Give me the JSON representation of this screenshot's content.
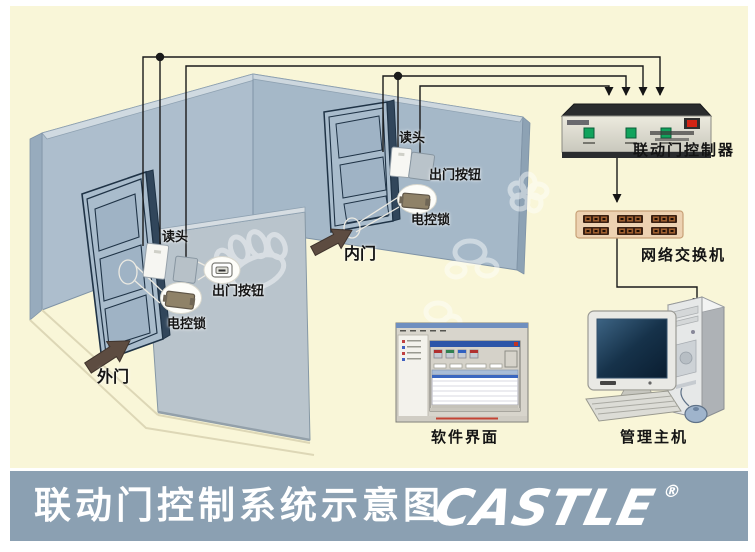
{
  "banner": {
    "title": "联动门控制系统示意图",
    "brand": "CASTLE",
    "registered_mark": "®"
  },
  "scene": {
    "outer_door": {
      "door_label": "外门",
      "reader_label": "读头",
      "exit_button_label": "出门按钮",
      "lock_label": "电控锁"
    },
    "inner_door": {
      "door_label": "内门",
      "reader_label": "读头",
      "exit_button_label": "出门按钮",
      "lock_label": "电控锁"
    },
    "equipment": {
      "controller_label": "联动门控制器",
      "switch_label": "网络交换机",
      "software_label": "软件界面",
      "host_label": "管理主机"
    }
  },
  "colors": {
    "background": "#f9f6d8",
    "banner_background": "#8ba0b2",
    "banner_text": "#ffffff",
    "wall_blue": "#adbecd",
    "partition_gray": "#b9c4cc",
    "wire_black": "#1a1a1a",
    "switch_body_tan": "#edd2b2",
    "controller_button_green": "#11a35c",
    "controller_switch_red": "#d22415",
    "door_arrow_brown": "#5d4c41"
  }
}
